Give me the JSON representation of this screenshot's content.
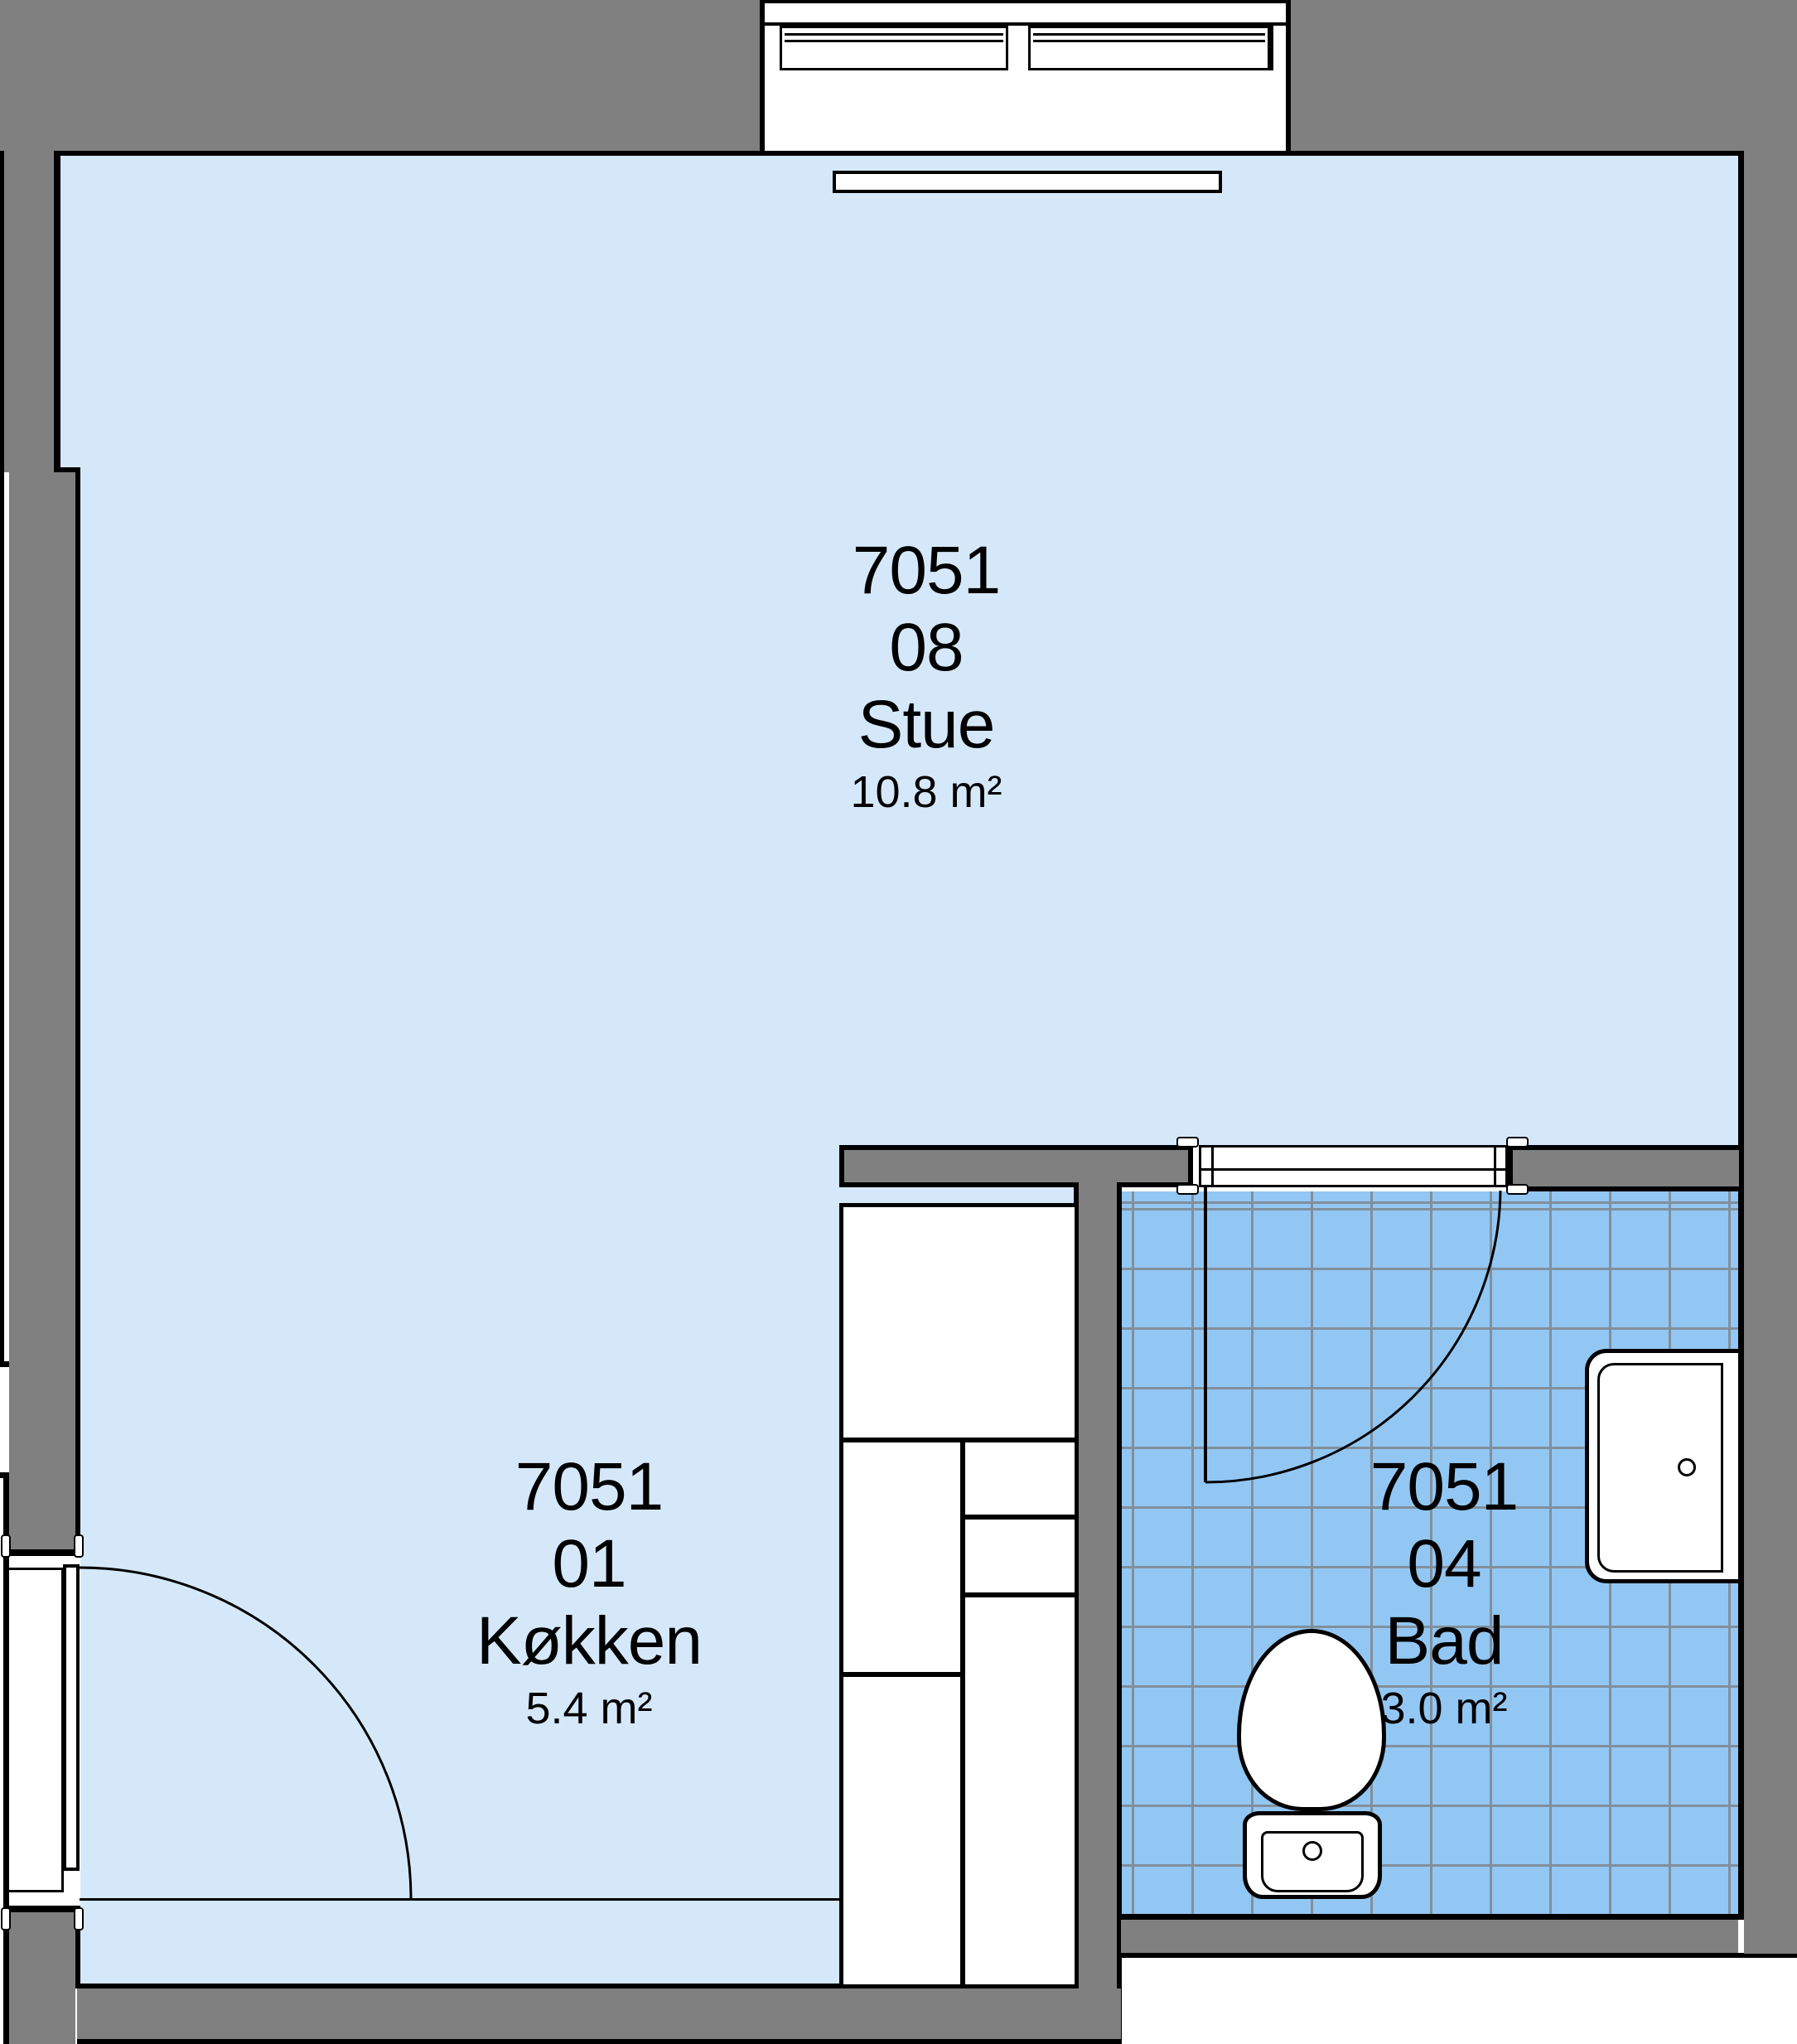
{
  "rooms": {
    "stue": {
      "code": "7051",
      "unit": "08",
      "name": "Stue",
      "area": "10.8 m²"
    },
    "kokken": {
      "code": "7051",
      "unit": "01",
      "name": "Køkken",
      "area": "5.4 m²"
    },
    "bad": {
      "code": "7051",
      "unit": "04",
      "name": "Bad",
      "area": "3.0 m²"
    }
  },
  "colors": {
    "room_fill": "#d5e8fa",
    "bathroom_tile_fill": "#93c7f3",
    "tile_grid_line": "#818f9b",
    "wall_fill": "#808080",
    "outline": "#000000",
    "fixture_fill": "#ffffff"
  },
  "fixtures": {
    "window": "double casement window (top wall)",
    "ceiling_light": "ceiling light fixture",
    "kitchen_cabinets": "kitchen cabinet run",
    "entrance_door": "entrance door with swing arc",
    "bathroom_door": "bathroom door with swing arc",
    "toilet": "toilet",
    "sink": "washbasin"
  }
}
